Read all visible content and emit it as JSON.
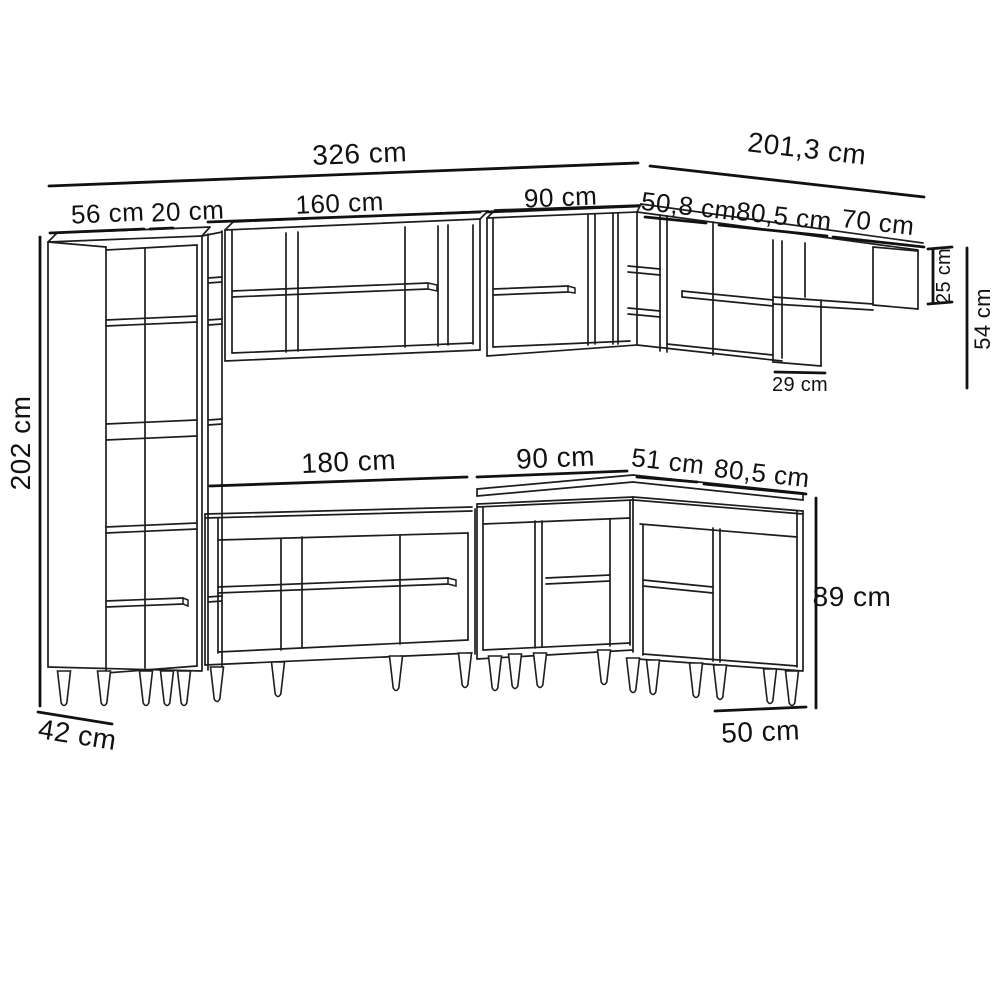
{
  "diagram": {
    "type": "kitchen-cabinet-dimension-drawing",
    "unit": "cm",
    "dimensions": {
      "total_width": "326 cm",
      "right_section_width": "201,3 cm",
      "tall_cabinet_width": "56 cm",
      "filler_width": "20 cm",
      "wall_cabinet_large_width": "160 cm",
      "wall_cabinet_small_width": "90 cm",
      "corner_wall_cabinet_width": "50,8 cm",
      "right_wall_cabinet_width": "80,5 cm",
      "wall_shelf_width": "70 cm",
      "tall_cabinet_height": "202 cm",
      "tall_cabinet_depth": "42 cm",
      "base_cabinet_large_width": "180 cm",
      "corner_base_cabinet_width": "90 cm",
      "corner_base_side_width": "51 cm",
      "right_base_cabinet_width": "80,5 cm",
      "wall_shelf_height": "25 cm",
      "wall_section_height": "54 cm",
      "wall_lower_box_depth": "29 cm",
      "base_cabinet_height": "89 cm",
      "base_cabinet_depth": "50 cm"
    }
  }
}
